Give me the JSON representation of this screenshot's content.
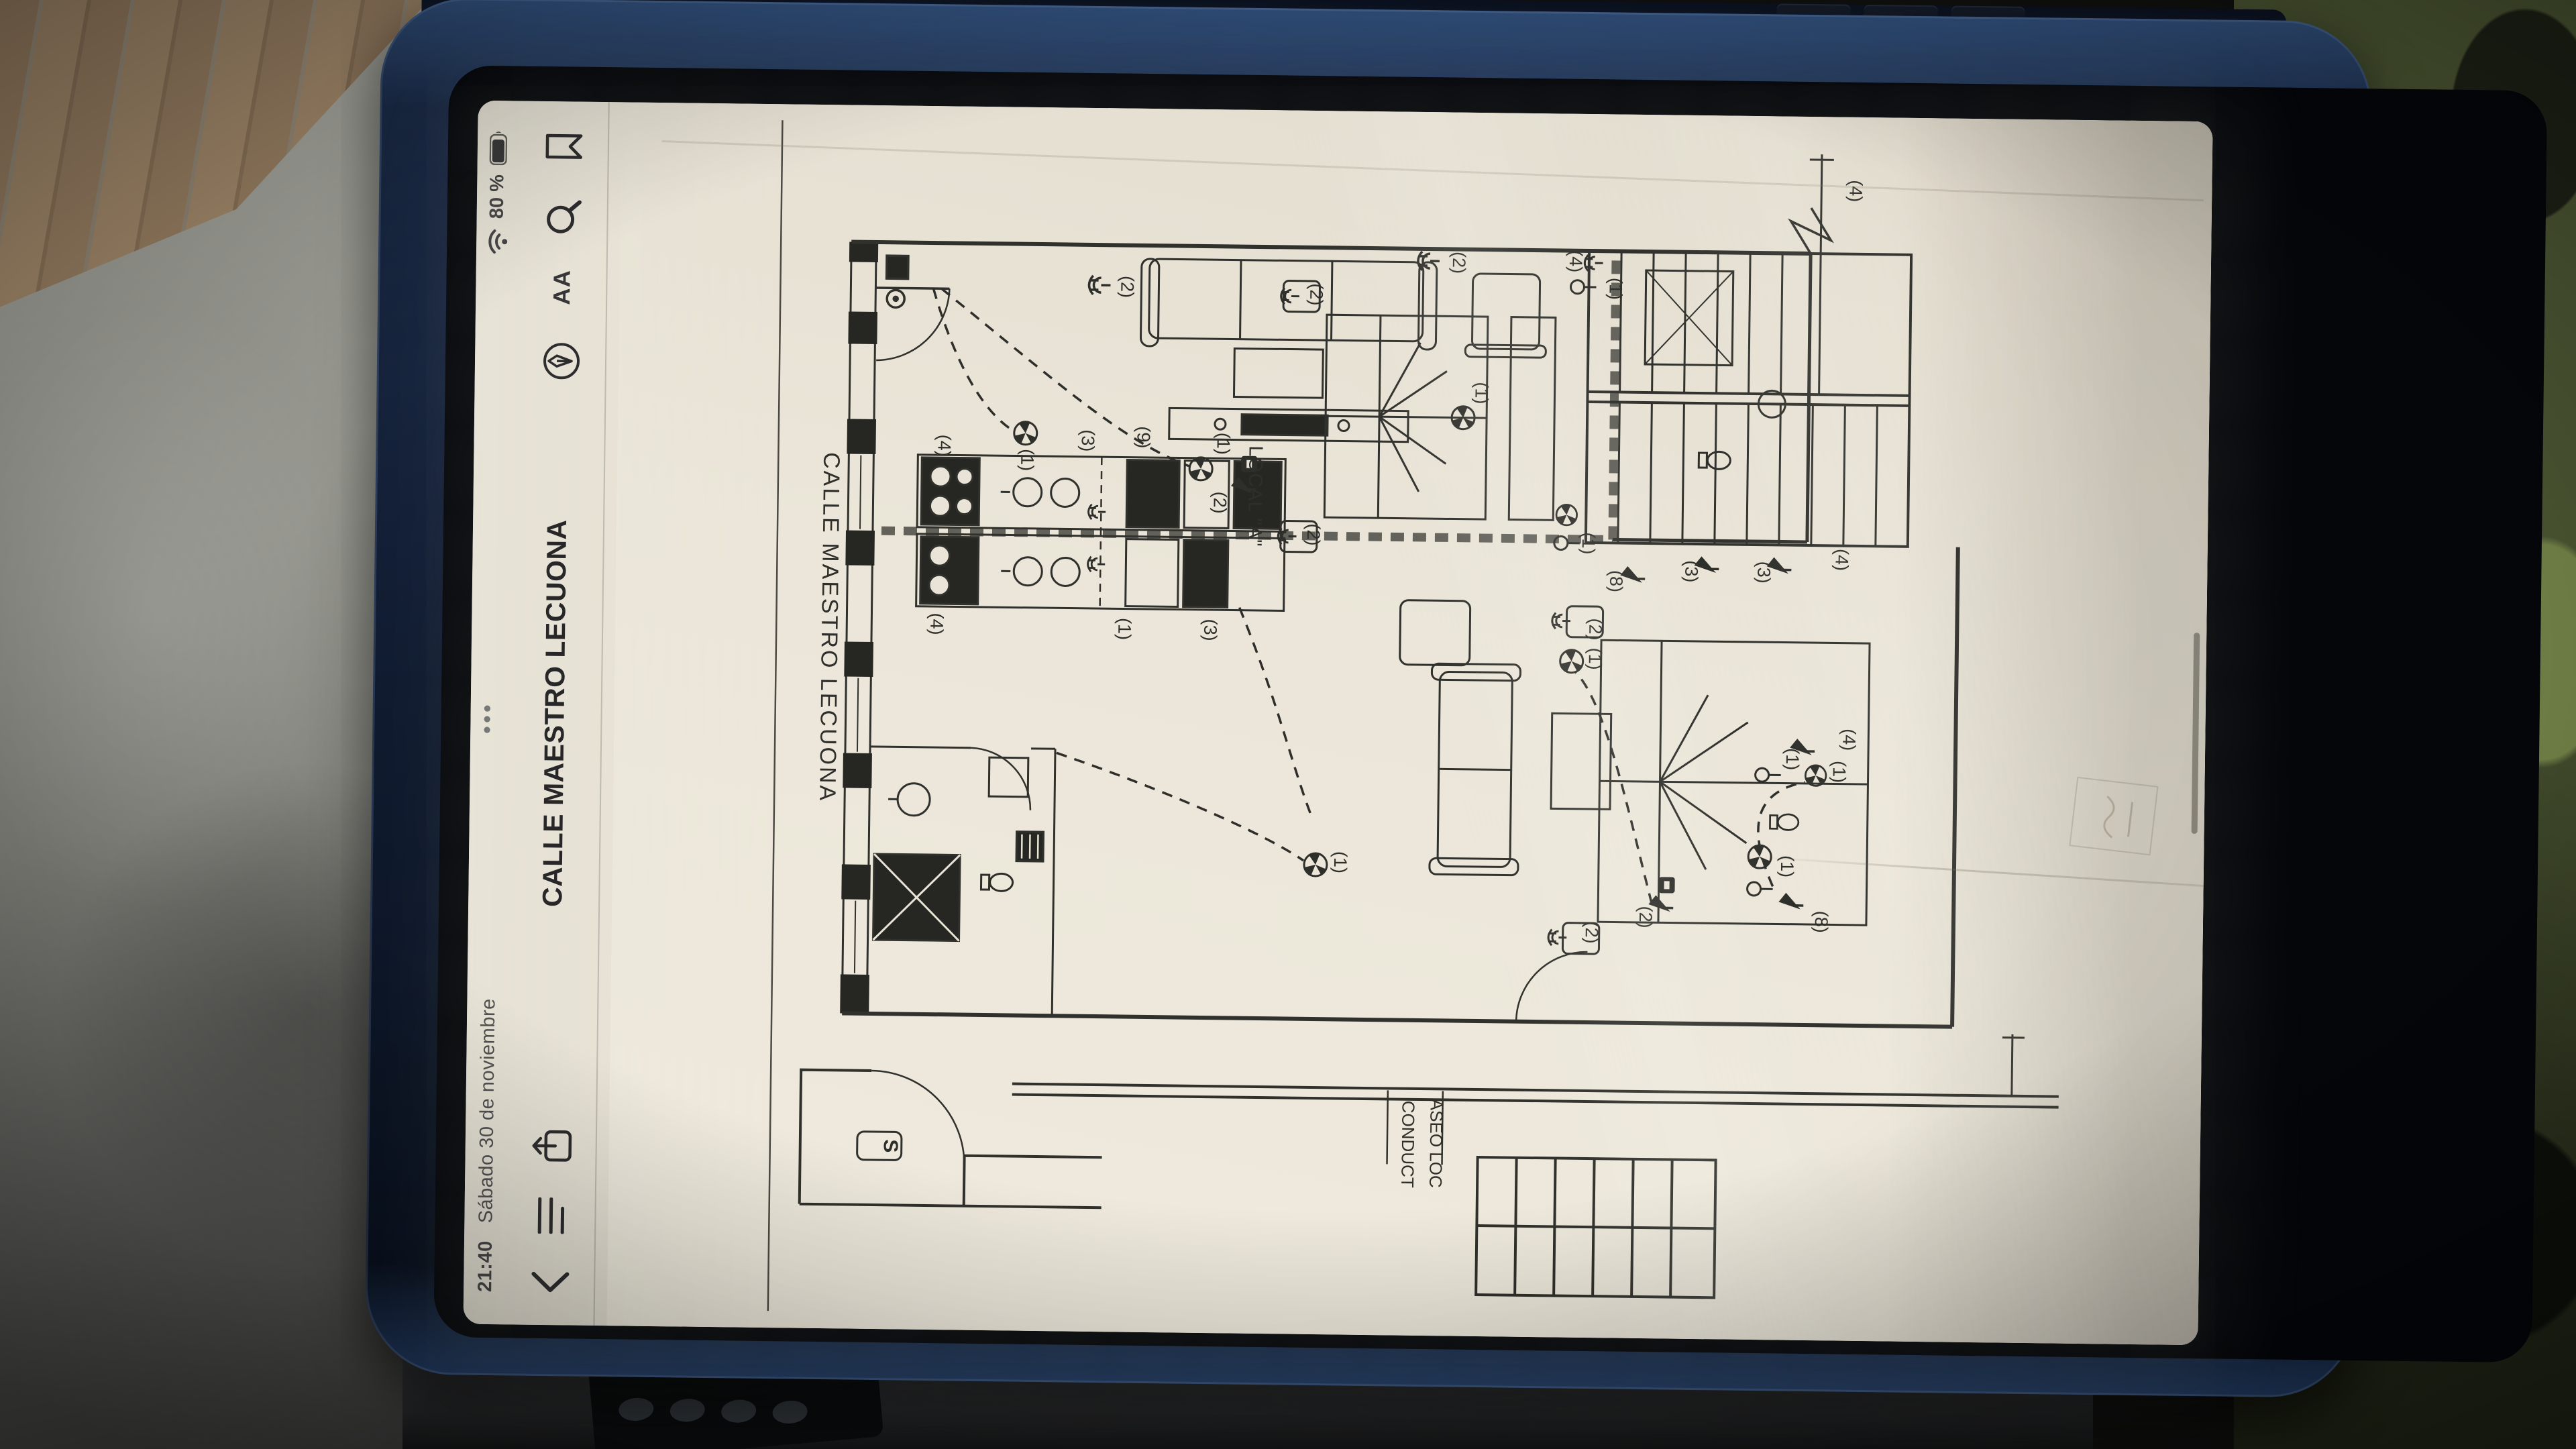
{
  "status_bar": {
    "time": "21:40",
    "date": "Sábado 30 de noviembre",
    "battery": "80 %",
    "multitask_dots": "•••"
  },
  "toolbar": {
    "title": "CALLE MAESTRO LECUONA",
    "text_size_label": "AA"
  },
  "viewer": {
    "page_indicator": "1 de 1"
  },
  "icon_names": [
    "wifi-icon",
    "battery-icon",
    "chevron-back-icon",
    "contents-list-icon",
    "share-icon",
    "markup-circle-icon",
    "text-size-icon",
    "search-icon",
    "bookmark-icon",
    "multitask-dots",
    "home-indicator"
  ],
  "plan": {
    "street_label": "CALLE MAESTRO LECUONA",
    "local_label": "LOCAL \"A\"",
    "duct_label_line1": "CONDUCT",
    "duct_label_line2": "ASEO LOC",
    "vestibule_symbol": "S",
    "circuit_labels": [
      [
        "(2)",
        1558,
        518
      ],
      [
        "(2)",
        1600,
        1012
      ],
      [
        "(4)",
        1604,
        1186
      ],
      [
        "(1)",
        1298,
        372
      ],
      [
        "(1)",
        1326,
        664
      ],
      [
        "(2)",
        1238,
        660
      ],
      [
        "(9)",
        1334,
        545
      ],
      [
        "(4)",
        1318,
        248
      ],
      [
        "(3)",
        1328,
        462
      ],
      [
        "(2)",
        1192,
        800
      ],
      [
        "(2)",
        1550,
        800
      ],
      [
        "(1)",
        1406,
        1048
      ],
      [
        "(8)",
        1128,
        1252
      ],
      [
        "(3)",
        1144,
        1364
      ],
      [
        "(3)",
        1144,
        1472
      ],
      [
        "(1)",
        1184,
        1210
      ],
      [
        "(1)",
        1564,
        1246
      ],
      [
        "(4)",
        1052,
        240
      ],
      [
        "(1)",
        1048,
        520
      ],
      [
        "(3)",
        1048,
        648
      ],
      [
        "(1)",
        704,
        846
      ],
      [
        "(1)",
        1012,
        1222
      ],
      [
        "(2)",
        628,
        1302
      ],
      [
        "(2)",
        604,
        1222
      ],
      [
        "(2)",
        1056,
        1222
      ],
      [
        "(1)",
        848,
        1588
      ],
      [
        "(8)",
        624,
        1564
      ],
      [
        "(1)",
        706,
        1512
      ],
      [
        "(1)",
        866,
        1518
      ],
      [
        "(4)",
        896,
        1602
      ],
      [
        "(4)",
        1164,
        1588
      ],
      [
        "(4)",
        1714,
        1602
      ]
    ]
  }
}
